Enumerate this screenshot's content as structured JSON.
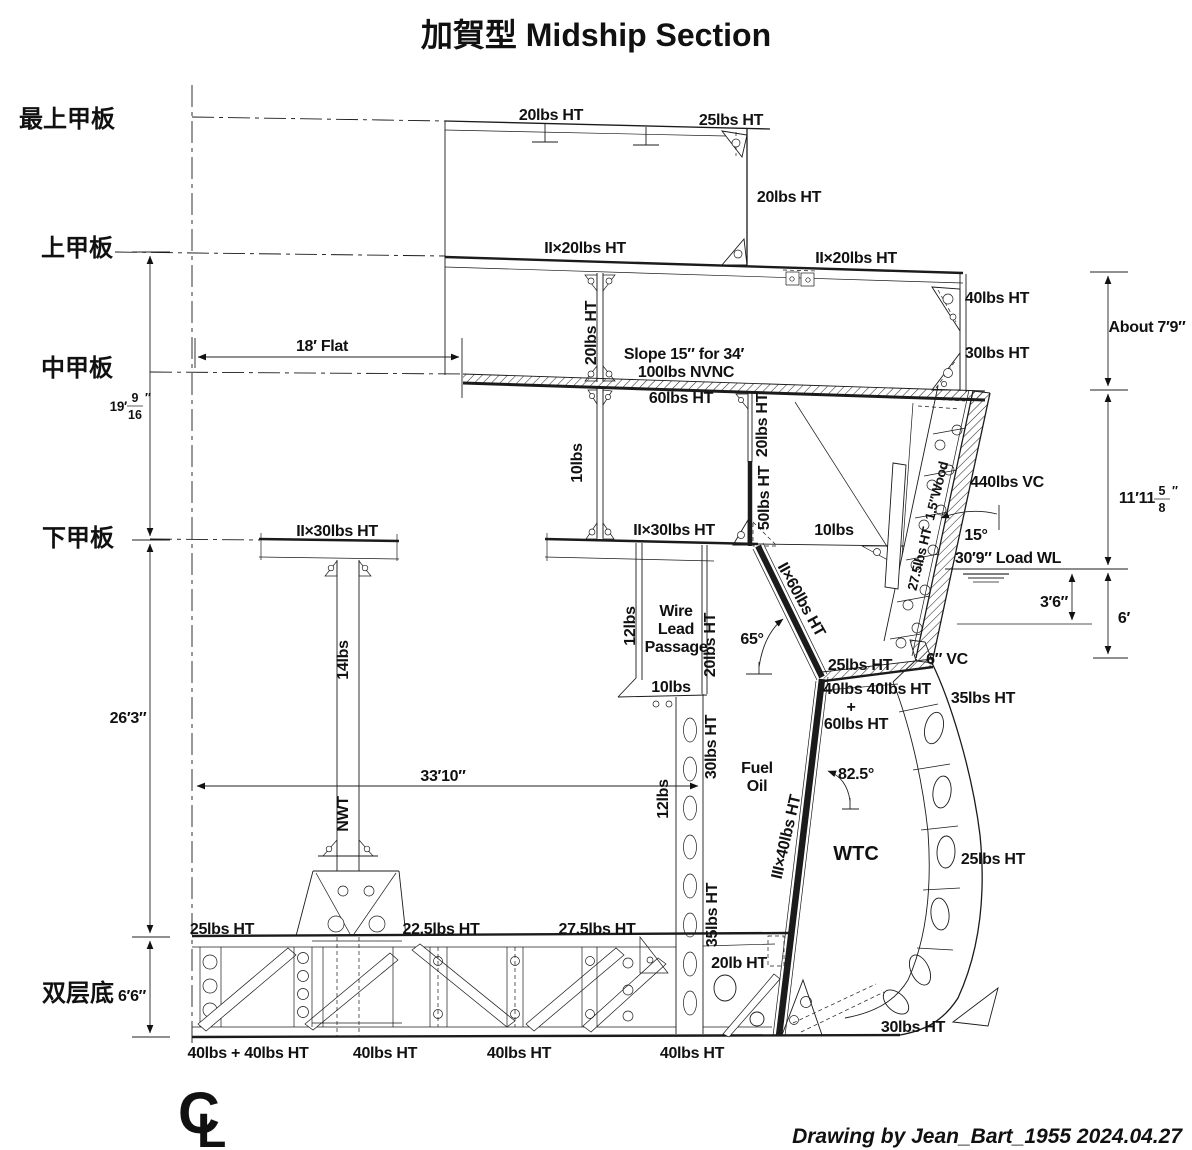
{
  "title": "加賀型 Midship Section",
  "credit": "Drawing by Jean_Bart_1955  2024.04.27",
  "decks": {
    "top": "最上甲板",
    "upper": "上甲板",
    "middle": "中甲板",
    "lower": "下甲板",
    "double_bottom": "双层底"
  },
  "dims": {
    "flat": "18′ Flat",
    "h19_feet": "19′",
    "h19_num": "9",
    "h19_den": "16",
    "h19_unit": "″",
    "h26": "26′3″",
    "h66": "6′6″",
    "w3310": "33′10″",
    "about79": "About 7′9″",
    "h1111_pre": "11′11",
    "h1111_num": "5",
    "h1111_den": "8",
    "h1111_unit": "″",
    "loadwl": "30′9″ Load WL",
    "d36": "3′6″",
    "d6": "6′",
    "a15": "15°",
    "a65": "65°",
    "a825": "82.5°"
  },
  "plates": {
    "top_deck": "20lbs HT",
    "top_deck_end": "25lbs HT",
    "deckhouse_side": "20lbs HT",
    "upper_deck_l": "II×20lbs HT",
    "upper_deck_r": "II×20lbs HT",
    "slope_note": "Slope 15″ for 34′",
    "armor_deck": "100lbs NVNC",
    "armor_backing": "60lbs HT",
    "side_40": "40lbs HT",
    "side_30": "30lbs HT",
    "pillar_20": "20lbs HT",
    "strut_10": "10lbs",
    "wall_20": "20lbs HT",
    "wall_50": "50lbs HT",
    "lower_deck_l": "II×30lbs HT",
    "lower_deck_m": "II×30lbs HT",
    "shelf_10": "10lbs",
    "belt": "440lbs VC",
    "wood": "1.5″Wood",
    "shell_275": "27.5lbs HT",
    "vc6": "6″ VC",
    "shell_35": "35lbs HT",
    "bhd_ii60": "II×60lbs HT",
    "slope_25": "25lbs HT",
    "slope_4040": "40lbs 40lbs HT",
    "plus": "+",
    "slope_60": "60lbs HT",
    "bhd_iii40": "III×40lbs HT",
    "shell_25": "25lbs HT",
    "bilge_30": "30lbs HT",
    "pillar_14": "14lbs",
    "nwt": "NWT",
    "wire_12": "12lbs",
    "wire_20": "20lbs HT",
    "wire_floor_10": "10lbs",
    "hold_30": "30lbs HT",
    "hold_12": "12lbs",
    "hold_35": "35lbs HT",
    "ledge_20": "20lb HT",
    "ib_25": "25lbs HT",
    "ib_225": "22.5lbs HT",
    "ib_275": "27.5lbs HT",
    "ob_4040": "40lbs + 40lbs HT",
    "ob_40a": "40lbs HT",
    "ob_40b": "40lbs HT",
    "ob_40c": "40lbs HT"
  },
  "compartments": {
    "wire_1": "Wire",
    "wire_2": "Lead",
    "wire_3": "Passage",
    "fuel_1": "Fuel",
    "fuel_2": "Oil",
    "wtc": "WTC"
  },
  "cl": {
    "c": "C",
    "l": "L"
  }
}
